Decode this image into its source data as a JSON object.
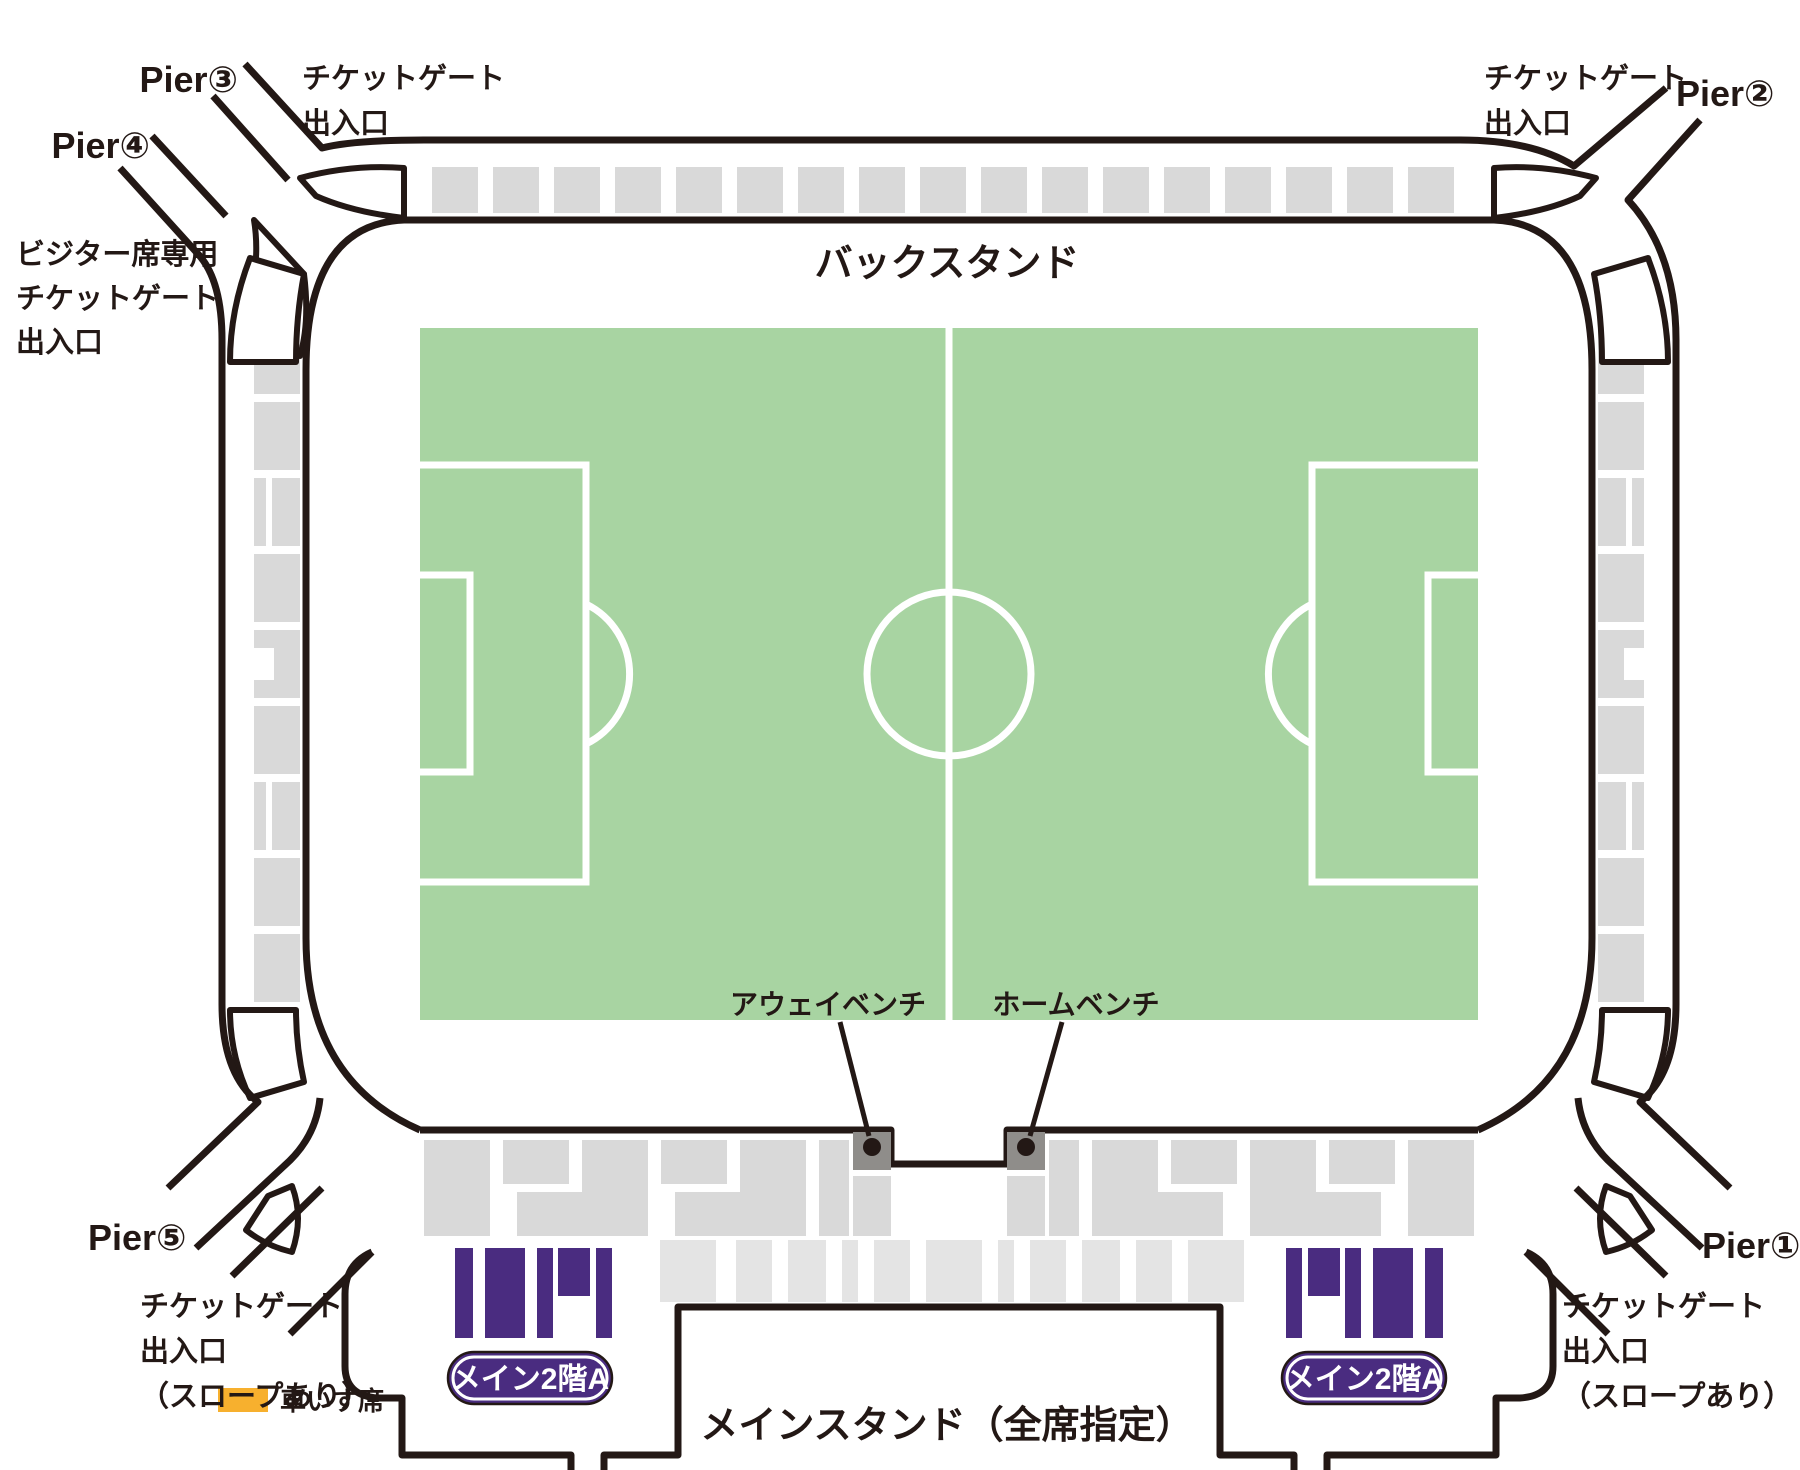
{
  "labels": {
    "back_stand": "バックスタンド",
    "main_stand": "メインスタンド（全席指定）",
    "away_bench": "アウェイベンチ",
    "home_bench": "ホームベンチ",
    "main_2f_a": "メイン2階A"
  },
  "legend": {
    "wheelchair": "車いす席"
  },
  "gates": {
    "tl": {
      "pier": "Pier③",
      "line1": "チケットゲート",
      "line2": "出入口"
    },
    "tl_visitor": {
      "pier": "Pier④",
      "line1": "ビジター席専用",
      "line2": "チケットゲート",
      "line3": "出入口"
    },
    "tr": {
      "pier": "Pier②",
      "line1": "チケットゲート",
      "line2": "出入口"
    },
    "bl": {
      "pier": "Pier⑤",
      "line1": "チケットゲート",
      "line2": "出入口",
      "line3": "（スロープあり）"
    },
    "br": {
      "pier": "Pier①",
      "line1": "チケットゲート",
      "line2": "出入口",
      "line3": "（スロープあり）"
    }
  },
  "colors": {
    "outline": "#231815",
    "seat_gray": "#d9d9d9",
    "seat_gray_light": "#e4e4e4",
    "pitch_green": "#a8d4a2",
    "line_white": "#ffffff",
    "purple": "#4a2c80",
    "orange": "#f7b02e",
    "bench_gray": "#8f8d8a"
  }
}
